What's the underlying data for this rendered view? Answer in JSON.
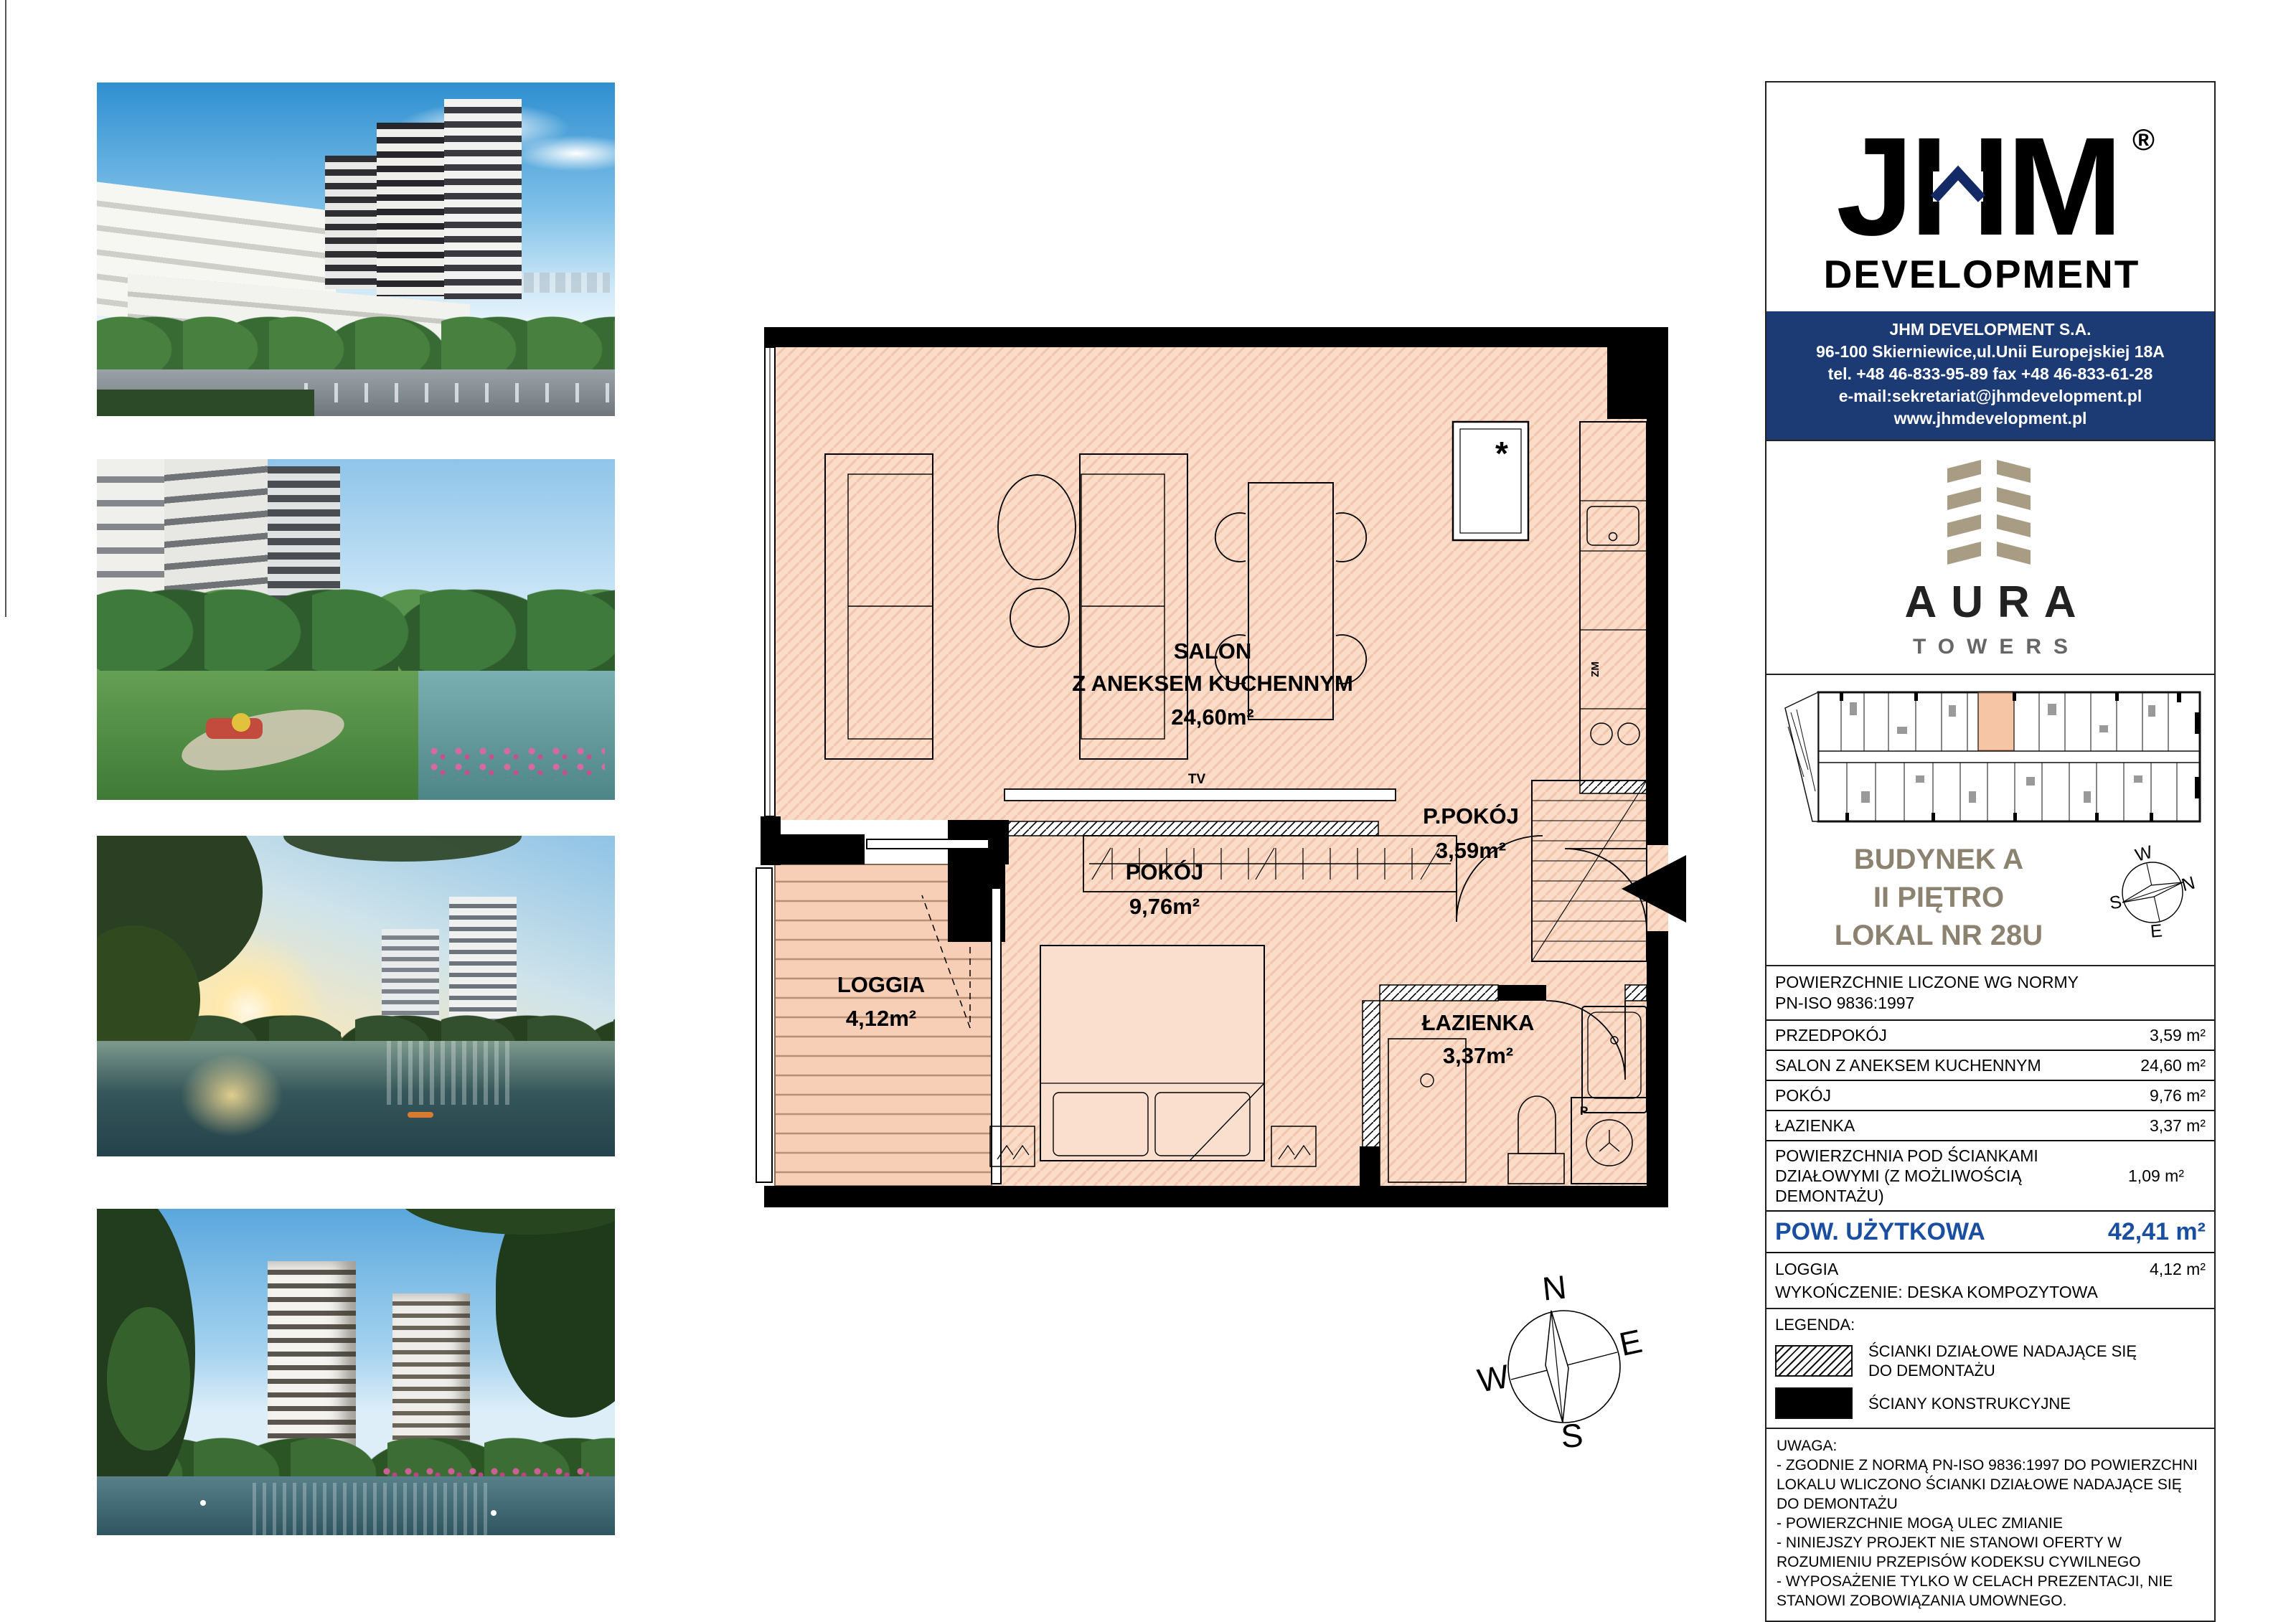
{
  "brand": {
    "jhm": "JHM",
    "registered": "®",
    "development": "DEVELOPMENT",
    "aura": "AURA",
    "towers": "TOWERS"
  },
  "contact": {
    "lines": [
      "JHM DEVELOPMENT S.A.",
      "96-100 Skierniewice,ul.Unii Europejskiej 18A",
      "tel. +48 46-833-95-89   fax +48 46-833-61-28",
      "e-mail:sekretariat@jhmdevelopment.pl",
      "www.jhmdevelopment.pl"
    ]
  },
  "unit": {
    "building": "BUDYNEK A",
    "floor": "II PIĘTRO",
    "number": "LOKAL NR 28U"
  },
  "compass": {
    "n": "N",
    "s": "S",
    "e": "E",
    "w": "W"
  },
  "plan": {
    "rooms": {
      "salon": {
        "name": "SALON",
        "name2": "Z ANEKSEM KUCHENNYM",
        "area": "24,60m²"
      },
      "ppokoj": {
        "name": "P.POKÓJ",
        "area": "3,59m²"
      },
      "pokoj": {
        "name": "POKÓJ",
        "area": "9,76m²"
      },
      "lazienka": {
        "name": "ŁAZIENKA",
        "area": "3,37m²"
      },
      "loggia": {
        "name": "LOGGIA",
        "area": "4,12m²"
      }
    },
    "labels": {
      "tv": "TV",
      "zm": "ZM",
      "p": "P",
      "star": "*"
    }
  },
  "table": {
    "header1": "POWIERZCHNIE LICZONE WG NORMY",
    "header2": "PN-ISO 9836:1997",
    "rows": [
      {
        "label": "PRZEDPOKÓJ",
        "value": "3,59 m²"
      },
      {
        "label": "SALON Z ANEKSEM KUCHENNYM",
        "value": "24,60 m²"
      },
      {
        "label": "POKÓJ",
        "value": "9,76 m²"
      },
      {
        "label": "ŁAZIENKA",
        "value": "3,37 m²"
      },
      {
        "label": "POWIERZCHNIA POD ŚCIANKAMI DZIAŁOWYMI (Z MOŻLIWOŚCIĄ DEMONTAŻU)",
        "value": "1,09 m²"
      }
    ],
    "total": {
      "label": "POW. UŻYTKOWA",
      "value": "42,41 m²"
    },
    "loggia": {
      "label": "LOGGIA",
      "value": "4,12 m²",
      "note": "WYKOŃCZENIE: DESKA KOMPOZYTOWA"
    }
  },
  "legend": {
    "title": "LEGENDA:",
    "partition": "ŚCIANKI DZIAŁOWE NADAJĄCE SIĘ DO DEMONTAŻU",
    "structural": "ŚCIANY KONSTRUKCYJNE"
  },
  "uwaga": {
    "title": "UWAGA:",
    "items": [
      "- ZGODNIE Z NORMĄ PN-ISO 9836:1997 DO POWIERZCHNI LOKALU WLICZONO ŚCIANKI DZIAŁOWE NADAJĄCE SIĘ DO DEMONTAŻU",
      "- POWIERZCHNIE MOGĄ ULEC ZMIANIE",
      "- NINIEJSZY PROJEKT NIE STANOWI OFERTY W ROZUMIENIU PRZEPISÓW KODEKSU CYWILNEGO",
      "- WYPOSAŻENIE TYLKO W CELACH PREZENTACJI, NIE STANOWI ZOBOWIĄZANIA UMOWNEGO."
    ]
  }
}
